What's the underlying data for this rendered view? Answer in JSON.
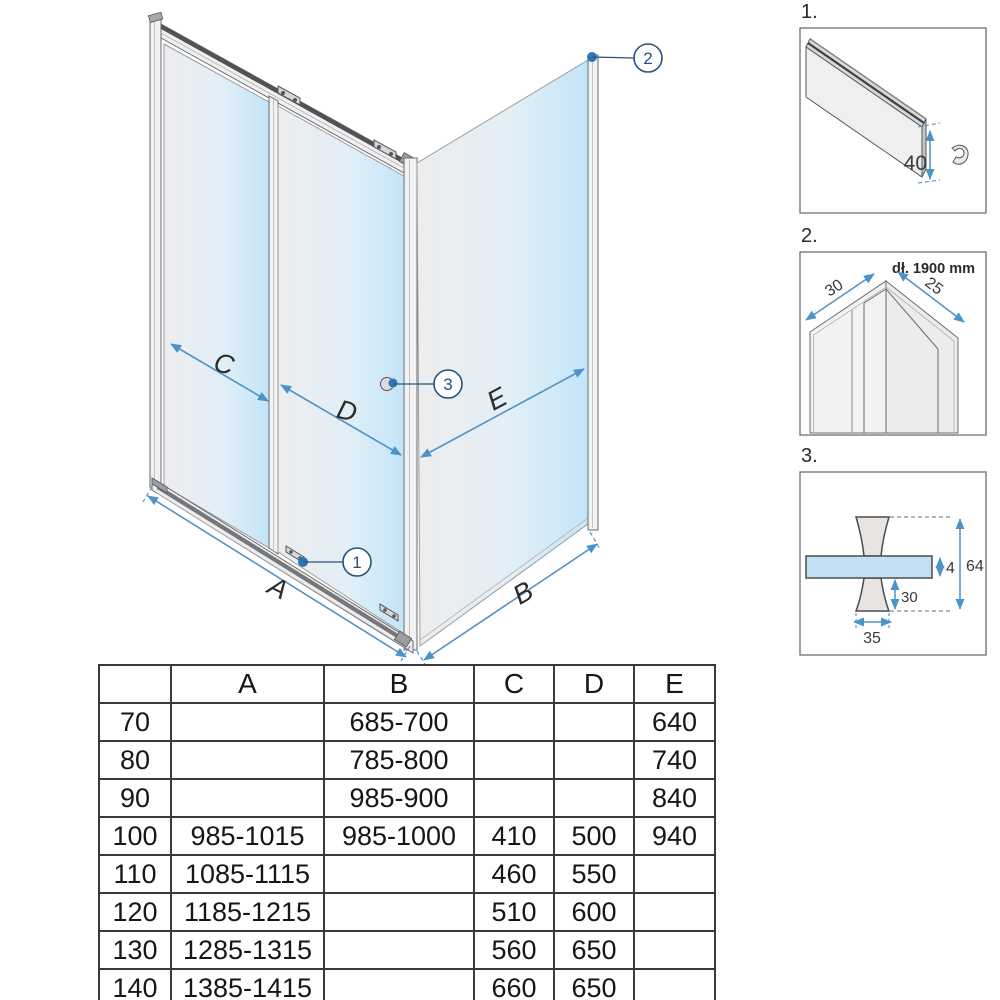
{
  "diagram": {
    "dimension_labels": {
      "A": "A",
      "B": "B",
      "C": "C",
      "D": "D",
      "E": "E"
    },
    "callouts": {
      "c1": "1",
      "c2": "2",
      "c3": "3"
    },
    "colors": {
      "accent": "#4e93c8",
      "callout": "#27527c",
      "glass_light": "#ececee",
      "glass_blue": "#c7e7f8"
    }
  },
  "details": {
    "d1": {
      "label": "1.",
      "height": "40"
    },
    "d2": {
      "label": "2.",
      "length_note": "dł. 1900 mm",
      "left": "30",
      "right": "25"
    },
    "d3": {
      "label": "3.",
      "glass_thickness": "4",
      "total_height": "64",
      "lower_height": "30",
      "base_width": "35"
    }
  },
  "table": {
    "headers": [
      "",
      "A",
      "B",
      "C",
      "D",
      "E"
    ],
    "rows": [
      [
        "70",
        "",
        "685-700",
        "",
        "",
        "640"
      ],
      [
        "80",
        "",
        "785-800",
        "",
        "",
        "740"
      ],
      [
        "90",
        "",
        "985-900",
        "",
        "",
        "840"
      ],
      [
        "100",
        "985-1015",
        "985-1000",
        "410",
        "500",
        "940"
      ],
      [
        "110",
        "1085-1115",
        "",
        "460",
        "550",
        ""
      ],
      [
        "120",
        "1185-1215",
        "",
        "510",
        "600",
        ""
      ],
      [
        "130",
        "1285-1315",
        "",
        "560",
        "650",
        ""
      ],
      [
        "140",
        "1385-1415",
        "",
        "660",
        "650",
        ""
      ]
    ]
  }
}
